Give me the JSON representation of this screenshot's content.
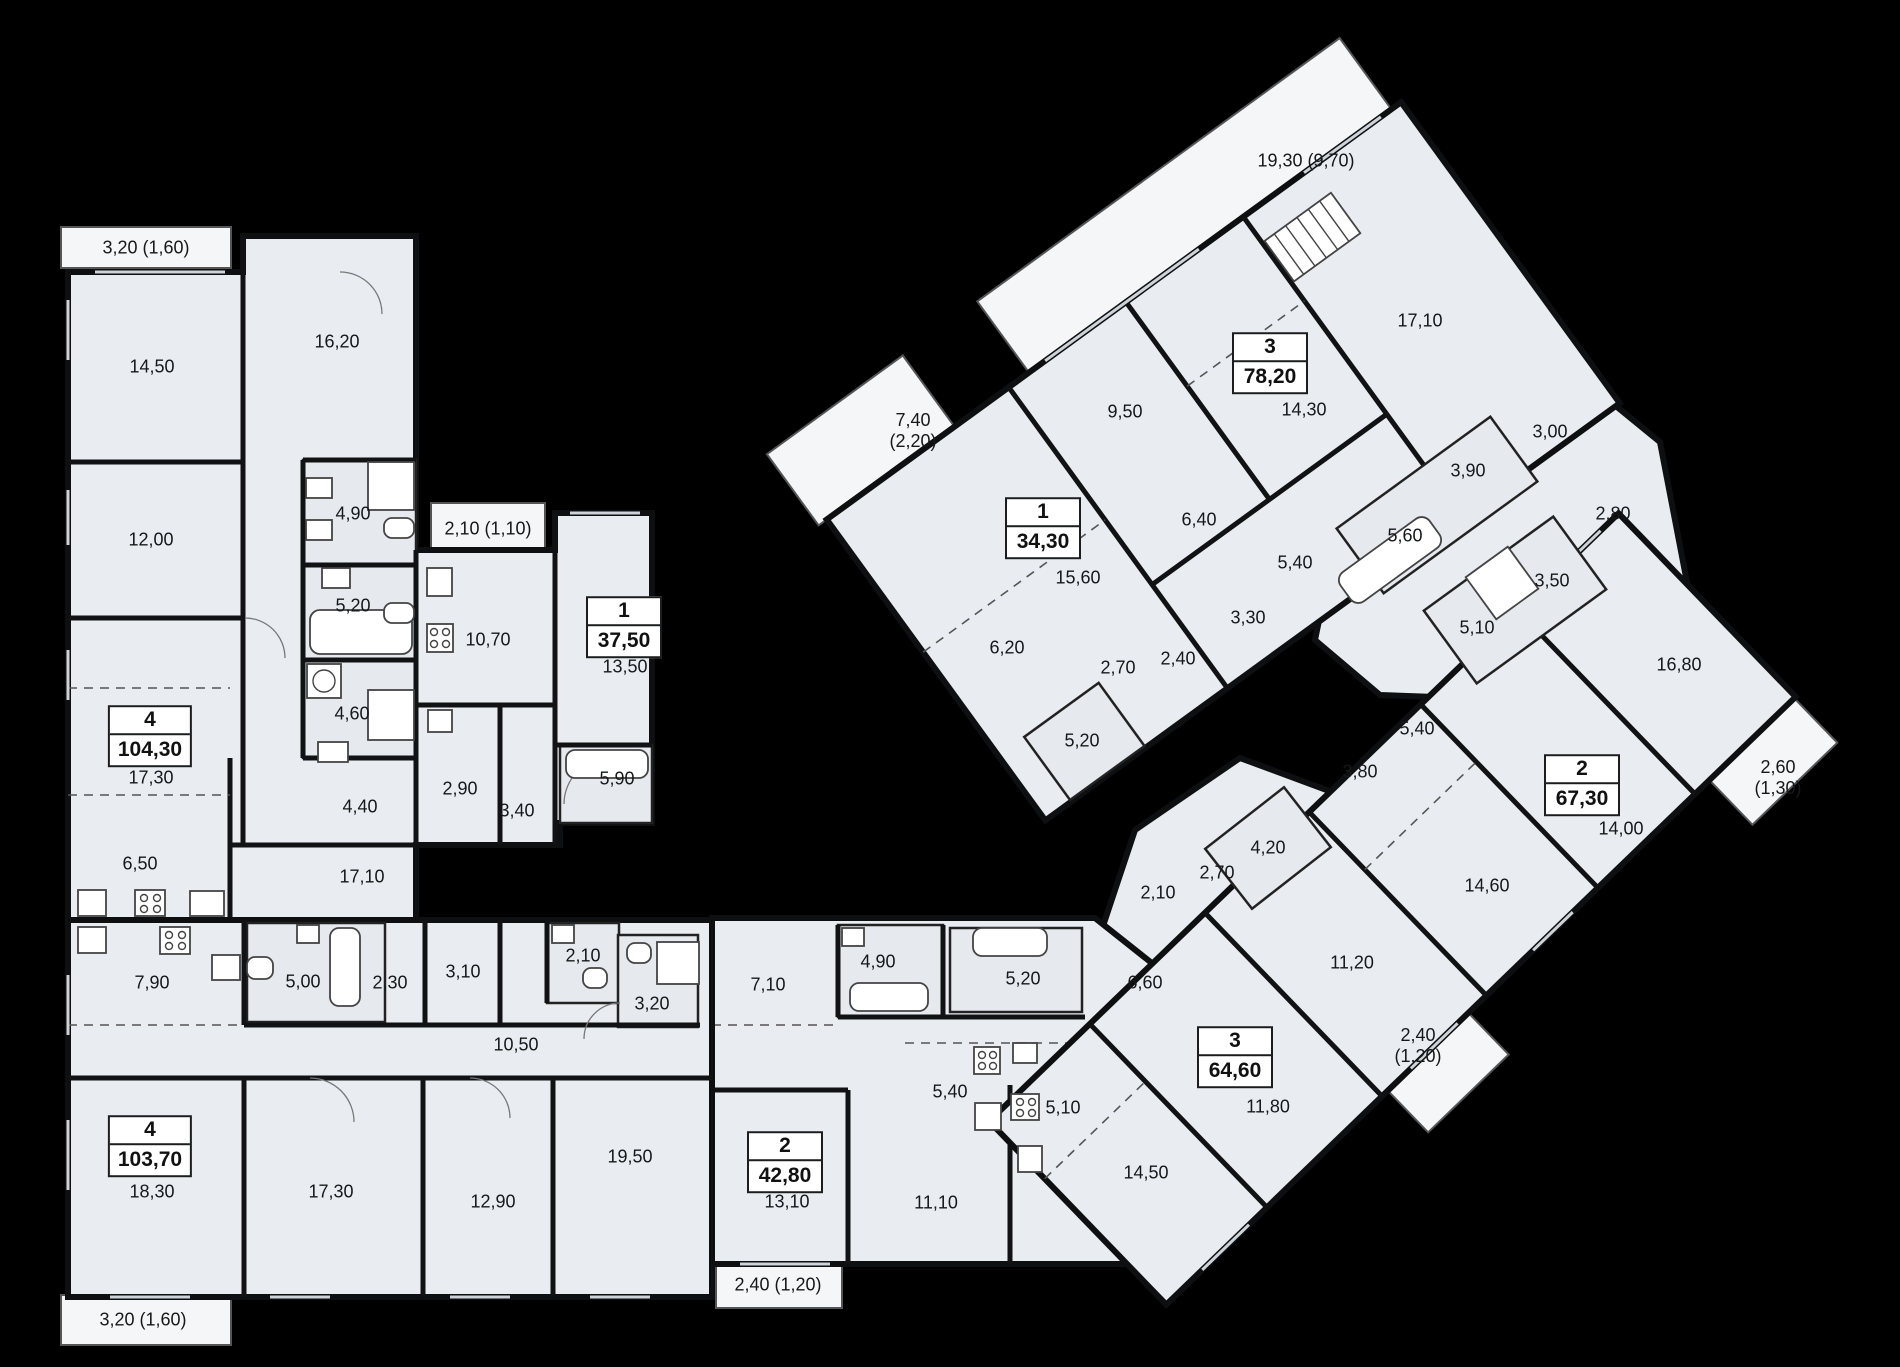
{
  "plan": {
    "background_color": "#000000",
    "floor_color": "#e9edf1",
    "wall_color": "#0d0f10",
    "hatch_color": "#c8ced4"
  },
  "apartments": [
    {
      "number": "4",
      "area": "104,30",
      "x": 150,
      "y": 736
    },
    {
      "number": "1",
      "area": "37,50",
      "x": 624,
      "y": 627
    },
    {
      "number": "4",
      "area": "103,70",
      "x": 150,
      "y": 1146
    },
    {
      "number": "2",
      "area": "42,80",
      "x": 785,
      "y": 1162
    },
    {
      "number": "3",
      "area": "64,60",
      "x": 1235,
      "y": 1057
    },
    {
      "number": "2",
      "area": "67,30",
      "x": 1582,
      "y": 785
    },
    {
      "number": "3",
      "area": "78,20",
      "x": 1270,
      "y": 363
    },
    {
      "number": "1",
      "area": "34,30",
      "x": 1043,
      "y": 528
    }
  ],
  "rooms": [
    {
      "text": "3,20 (1,60)",
      "x": 146,
      "y": 248
    },
    {
      "text": "14,50",
      "x": 152,
      "y": 367
    },
    {
      "text": "16,20",
      "x": 337,
      "y": 342
    },
    {
      "text": "12,00",
      "x": 151,
      "y": 540
    },
    {
      "text": "4,90",
      "x": 353,
      "y": 514
    },
    {
      "text": "5,20",
      "x": 353,
      "y": 606
    },
    {
      "text": "4,60",
      "x": 352,
      "y": 714
    },
    {
      "text": "2,10 (1,10)",
      "x": 488,
      "y": 529
    },
    {
      "text": "10,70",
      "x": 488,
      "y": 640
    },
    {
      "text": "13,50",
      "x": 625,
      "y": 667
    },
    {
      "text": "5,90",
      "x": 617,
      "y": 779
    },
    {
      "text": "2,90",
      "x": 460,
      "y": 789
    },
    {
      "text": "3,40",
      "x": 517,
      "y": 811
    },
    {
      "text": "4,40",
      "x": 360,
      "y": 807
    },
    {
      "text": "17,10",
      "x": 362,
      "y": 877
    },
    {
      "text": "17,30",
      "x": 151,
      "y": 778
    },
    {
      "text": "6,50",
      "x": 140,
      "y": 864
    },
    {
      "text": "7,90",
      "x": 152,
      "y": 983
    },
    {
      "text": "5,00",
      "x": 303,
      "y": 982
    },
    {
      "text": "2,30",
      "x": 390,
      "y": 983
    },
    {
      "text": "3,10",
      "x": 463,
      "y": 972
    },
    {
      "text": "2,10",
      "x": 583,
      "y": 956
    },
    {
      "text": "3,20",
      "x": 652,
      "y": 1004
    },
    {
      "text": "10,50",
      "x": 516,
      "y": 1045
    },
    {
      "text": "18,30",
      "x": 152,
      "y": 1192
    },
    {
      "text": "17,30",
      "x": 331,
      "y": 1192
    },
    {
      "text": "12,90",
      "x": 493,
      "y": 1202
    },
    {
      "text": "19,50",
      "x": 630,
      "y": 1157
    },
    {
      "text": "3,20 (1,60)",
      "x": 143,
      "y": 1320
    },
    {
      "text": "7,10",
      "x": 768,
      "y": 985
    },
    {
      "text": "4,90",
      "x": 878,
      "y": 962
    },
    {
      "text": "5,20",
      "x": 1023,
      "y": 979
    },
    {
      "text": "13,10",
      "x": 787,
      "y": 1202
    },
    {
      "text": "11,10",
      "x": 936,
      "y": 1203
    },
    {
      "text": "5,40",
      "x": 950,
      "y": 1092
    },
    {
      "text": "5,10",
      "x": 1063,
      "y": 1108
    },
    {
      "text": "2,40 (1,20)",
      "x": 778,
      "y": 1285
    },
    {
      "text": "14,50",
      "x": 1146,
      "y": 1173
    },
    {
      "text": "6,60",
      "x": 1145,
      "y": 983
    },
    {
      "text": "11,80",
      "x": 1268,
      "y": 1107
    },
    {
      "text": "11,20",
      "x": 1352,
      "y": 963
    },
    {
      "text": "2,40\n(1,20)",
      "x": 1418,
      "y": 1046
    },
    {
      "text": "14,60",
      "x": 1487,
      "y": 886
    },
    {
      "text": "14,00",
      "x": 1621,
      "y": 829
    },
    {
      "text": "16,80",
      "x": 1679,
      "y": 665
    },
    {
      "text": "2,60\n(1,30)",
      "x": 1778,
      "y": 778
    },
    {
      "text": "5,40",
      "x": 1417,
      "y": 729
    },
    {
      "text": "3,80",
      "x": 1360,
      "y": 772
    },
    {
      "text": "4,20",
      "x": 1268,
      "y": 848
    },
    {
      "text": "2,70",
      "x": 1217,
      "y": 873
    },
    {
      "text": "2,10",
      "x": 1158,
      "y": 893
    },
    {
      "text": "3,00",
      "x": 1550,
      "y": 432
    },
    {
      "text": "3,90",
      "x": 1468,
      "y": 471
    },
    {
      "text": "5,60",
      "x": 1405,
      "y": 536
    },
    {
      "text": "5,40",
      "x": 1295,
      "y": 563
    },
    {
      "text": "3,30",
      "x": 1248,
      "y": 618
    },
    {
      "text": "3,50",
      "x": 1552,
      "y": 581
    },
    {
      "text": "5,10",
      "x": 1477,
      "y": 628
    },
    {
      "text": "2,80",
      "x": 1613,
      "y": 514
    },
    {
      "text": "2,40",
      "x": 1178,
      "y": 659
    },
    {
      "text": "19,30 (9,70)",
      "x": 1306,
      "y": 161
    },
    {
      "text": "17,10",
      "x": 1420,
      "y": 321
    },
    {
      "text": "9,50",
      "x": 1125,
      "y": 412
    },
    {
      "text": "14,30",
      "x": 1304,
      "y": 410
    },
    {
      "text": "7,40\n(2,20)",
      "x": 913,
      "y": 431
    },
    {
      "text": "15,60",
      "x": 1078,
      "y": 578
    },
    {
      "text": "6,40",
      "x": 1199,
      "y": 520
    },
    {
      "text": "6,20",
      "x": 1007,
      "y": 648
    },
    {
      "text": "2,70",
      "x": 1118,
      "y": 668
    },
    {
      "text": "5,20",
      "x": 1082,
      "y": 741
    }
  ]
}
